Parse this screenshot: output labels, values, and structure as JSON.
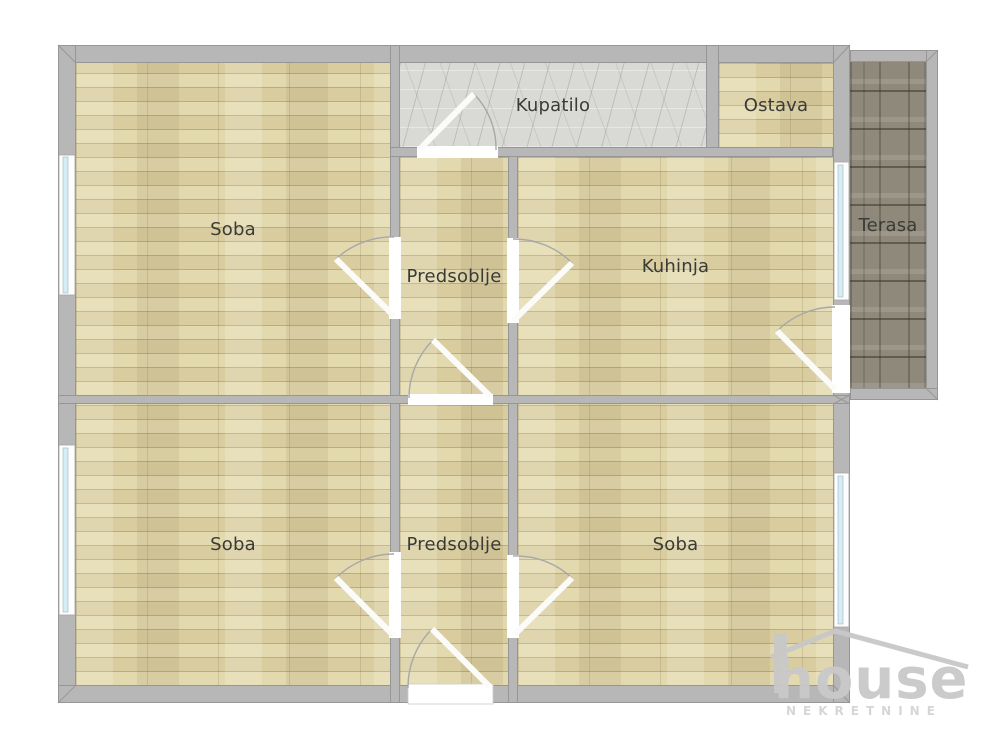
{
  "plan_title": "Apartment floor plan",
  "rooms": [
    {
      "id": "soba-top-left",
      "label": "Soba",
      "floor": "wood"
    },
    {
      "id": "kupatilo",
      "label": "Kupatilo",
      "floor": "marble"
    },
    {
      "id": "ostava",
      "label": "Ostava",
      "floor": "wood"
    },
    {
      "id": "predsoblje-top",
      "label": "Predsoblje",
      "floor": "wood"
    },
    {
      "id": "kuhinja",
      "label": "Kuhinja",
      "floor": "wood"
    },
    {
      "id": "terasa",
      "label": "Terasa",
      "floor": "tile"
    },
    {
      "id": "soba-bottom-left",
      "label": "Soba",
      "floor": "wood"
    },
    {
      "id": "predsoblje-bottom",
      "label": "Predsoblje",
      "floor": "wood"
    },
    {
      "id": "soba-bottom-right",
      "label": "Soba",
      "floor": "wood"
    }
  ],
  "watermark": {
    "brand": "house",
    "subtitle": "NEKRETNINE"
  },
  "colors": {
    "wall": "#b7b7b7",
    "wall_border": "#969696",
    "wood_floor": "#dcd1a4",
    "marble_floor": "#d9d9d6",
    "terrace_tile": "#8f897b",
    "window_glass": "#d7edf5",
    "door_leaf": "#ffffff",
    "door_arc": "#a8a8a8",
    "label_text": "#3b3b36",
    "watermark_gray": "#c9c9c9",
    "background": "#ffffff"
  }
}
